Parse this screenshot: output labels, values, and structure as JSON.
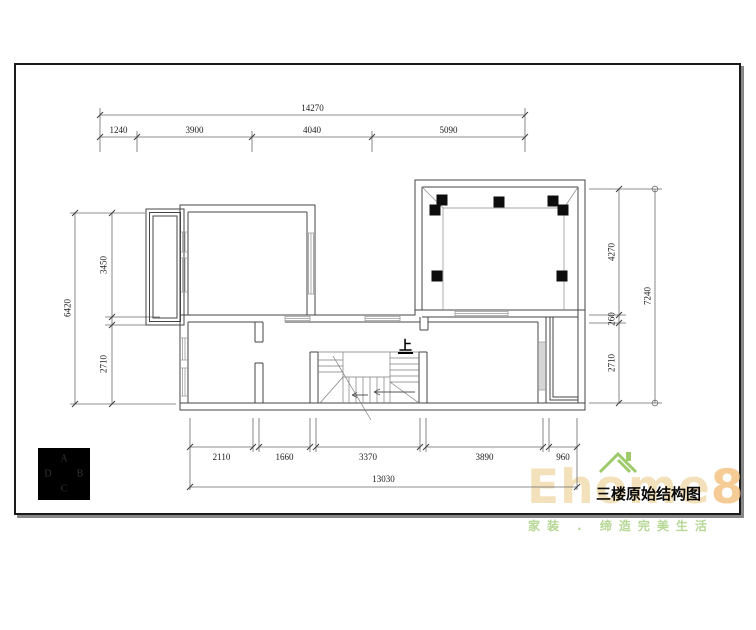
{
  "drawing": {
    "title": "三楼原始结构图",
    "stairs_up_label": "上"
  },
  "compass": {
    "letter_top": "A",
    "letter_right": "B",
    "letter_bottom": "C",
    "letter_left": "D"
  },
  "dimensions": {
    "top": {
      "total": "14270",
      "segments": [
        "1240",
        "3900",
        "4040",
        "5090"
      ]
    },
    "left": {
      "total": "6420",
      "segments": [
        "3450",
        "2710"
      ]
    },
    "right": {
      "total": "7240",
      "segments": [
        "4270",
        "260",
        "2710"
      ]
    },
    "bottom": {
      "total": "13030",
      "segments": [
        "2110",
        "1660",
        "3370",
        "3890",
        "960"
      ]
    }
  },
  "watermark": {
    "brand": "Ehome",
    "brand_suffix": "8",
    "slogan": "家装 . 缔造完美生活"
  },
  "colors": {
    "wall": "#454545",
    "dimension_line": "#6a6a6a",
    "column": "#0d0d0d",
    "watermark_tan": "#f0d8a8",
    "watermark_green": "#9ecb6a"
  }
}
